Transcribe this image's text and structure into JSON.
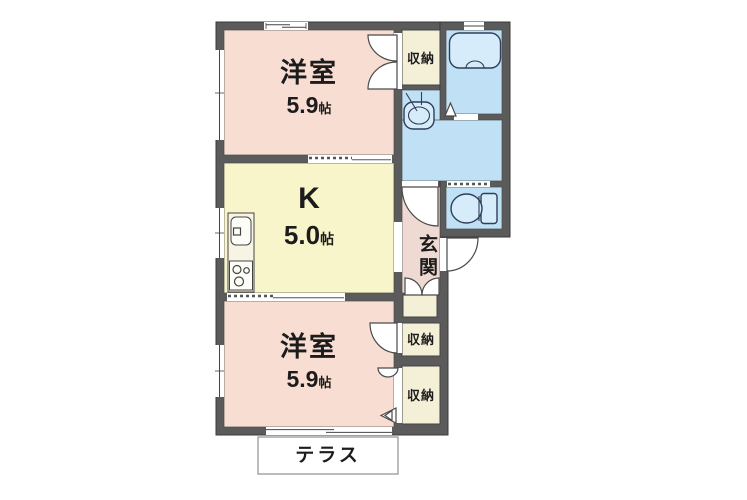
{
  "colors": {
    "wall": "#5b5b5b",
    "room_pink": "#f8ddd2",
    "kitchen_yellow": "#f8f5ca",
    "water_blue": "#bfe0f5",
    "closet_cream": "#f4f0d8",
    "entrance_pink": "#efd9d3",
    "fixture_blue": "#d6ecfa",
    "line": "#444444",
    "terrace_border": "#909090",
    "text": "#1c1c1c"
  },
  "rooms": {
    "bedroom_top": {
      "name": "洋室",
      "size_value": "5.9",
      "size_unit": "帖"
    },
    "kitchen": {
      "name": "K",
      "size_value": "5.0",
      "size_unit": "帖"
    },
    "bedroom_bottom": {
      "name": "洋室",
      "size_value": "5.9",
      "size_unit": "帖"
    },
    "closet_top": {
      "label": "収納"
    },
    "closet_middle": {
      "label": "収納"
    },
    "closet_bottom": {
      "label": "収納"
    },
    "entrance": {
      "label": "玄関"
    },
    "terrace": {
      "label": "テラス"
    }
  },
  "fixtures": {
    "bathtub": "bathtub",
    "washbasin": "washbasin",
    "toilet": "toilet",
    "kitchen_sink": "kitchen-sink",
    "stove": "stove"
  }
}
